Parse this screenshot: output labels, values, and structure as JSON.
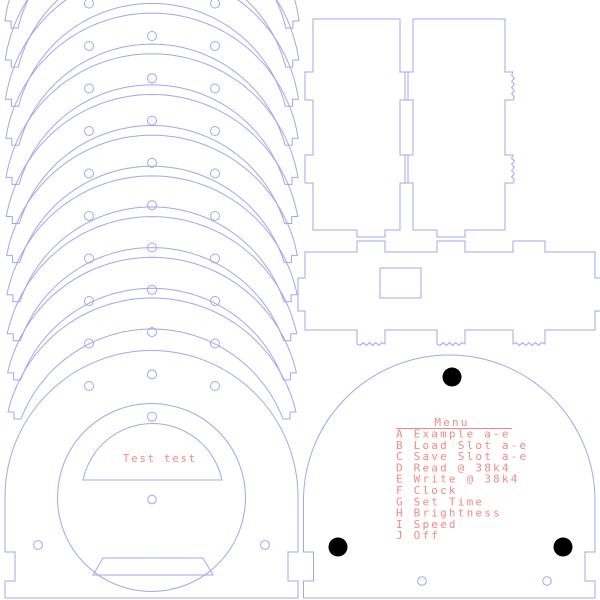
{
  "colors": {
    "background": "#ffffff",
    "line": "#a2a6ec",
    "text": "#f08989",
    "dot": "#000000"
  },
  "front_panel_label": "Test test",
  "menu": {
    "title": "Menu",
    "items": [
      "A Example a-e",
      "B Load Slot a-e",
      "C Save Slot a-e",
      "D Read @ 38k4",
      "E Write @ 38k4",
      "F Clock",
      "G Set Time",
      "H Brightness",
      "I Speed",
      "J Off"
    ]
  },
  "drawing": {
    "arch_stack": {
      "count": 11,
      "cx": 152,
      "outer_r": 148,
      "peak0": -109,
      "peak_step": 40.7,
      "foot0": 21,
      "foot_step": 39.1,
      "foot_w": 13,
      "notch_d": 7,
      "band": 31
    },
    "holes": {
      "r": 4.5,
      "center": {
        "x": 152,
        "y0": 36,
        "step": 42.3,
        "n": 10
      },
      "sides": {
        "xs": [
          89,
          215
        ],
        "y0": 3.5,
        "step": 42.5,
        "n": 10
      }
    },
    "side_panels": {
      "y1": 19,
      "y2": 230,
      "tab_out": 8,
      "btab_h": 7,
      "wave_amp": 1.4,
      "tabs": [
        [
          72,
          100
        ],
        [
          155,
          183
        ]
      ],
      "panels": [
        {
          "x1": 313,
          "x2": 400,
          "btab": [
            357,
            385
          ],
          "wavy": false
        },
        {
          "x1": 413,
          "x2": 505,
          "btab": [
            437,
            465
          ],
          "wavy": true
        }
      ]
    },
    "back_panel": {
      "x1": 305,
      "x2": 595,
      "y1": 252,
      "y2": 330,
      "ttabs": [
        [
          357,
          385
        ],
        [
          437,
          465
        ],
        [
          513,
          545
        ]
      ],
      "tab_up": 11,
      "btabs": [
        [
          357,
          385
        ],
        [
          437,
          465
        ],
        [
          513,
          545
        ]
      ],
      "tab_down": 14,
      "stab": [
        278,
        311
      ],
      "stab_out": 7,
      "wave_amp": 1.4,
      "hole": [
        380,
        268,
        41,
        30
      ]
    },
    "front_panel": {
      "x1": 5,
      "x2": 298,
      "spring": 497,
      "bottom": 598,
      "notch": [
        552,
        581
      ],
      "notch_d": 10,
      "circle": [
        151.5,
        497.5,
        94
      ],
      "window": {
        "x1": 83,
        "x2": 222,
        "y": 480,
        "r": 71
      },
      "center_hole": [
        152,
        499.5,
        4.2
      ],
      "corner_holes": [
        [
          38,
          545
        ],
        [
          265,
          545
        ]
      ],
      "ch_r": 4.4,
      "trap": [
        [
          103,
          558
        ],
        [
          203,
          558
        ],
        [
          213,
          575
        ],
        [
          93,
          575
        ]
      ]
    },
    "menu_panel": {
      "x1": 303.5,
      "x2": 595,
      "spring": 497,
      "bottom": 598,
      "notch": [
        552,
        581
      ],
      "notch_d": 10,
      "dots": [
        [
          452,
          377
        ],
        [
          338,
          547
        ],
        [
          563,
          547
        ]
      ],
      "dot_r": 9.5,
      "holes": [
        [
          422,
          581
        ],
        [
          547,
          581
        ]
      ],
      "hole_r": 4.3
    },
    "text_layout": {
      "menu_left_x": 396,
      "menu_first_baseline": 437.5,
      "menu_line_step": 11.3,
      "title_x": 452,
      "title_baseline": 426,
      "underline": [
        396,
        512,
        428.5
      ],
      "label_x": 123,
      "label_baseline": 462
    }
  }
}
